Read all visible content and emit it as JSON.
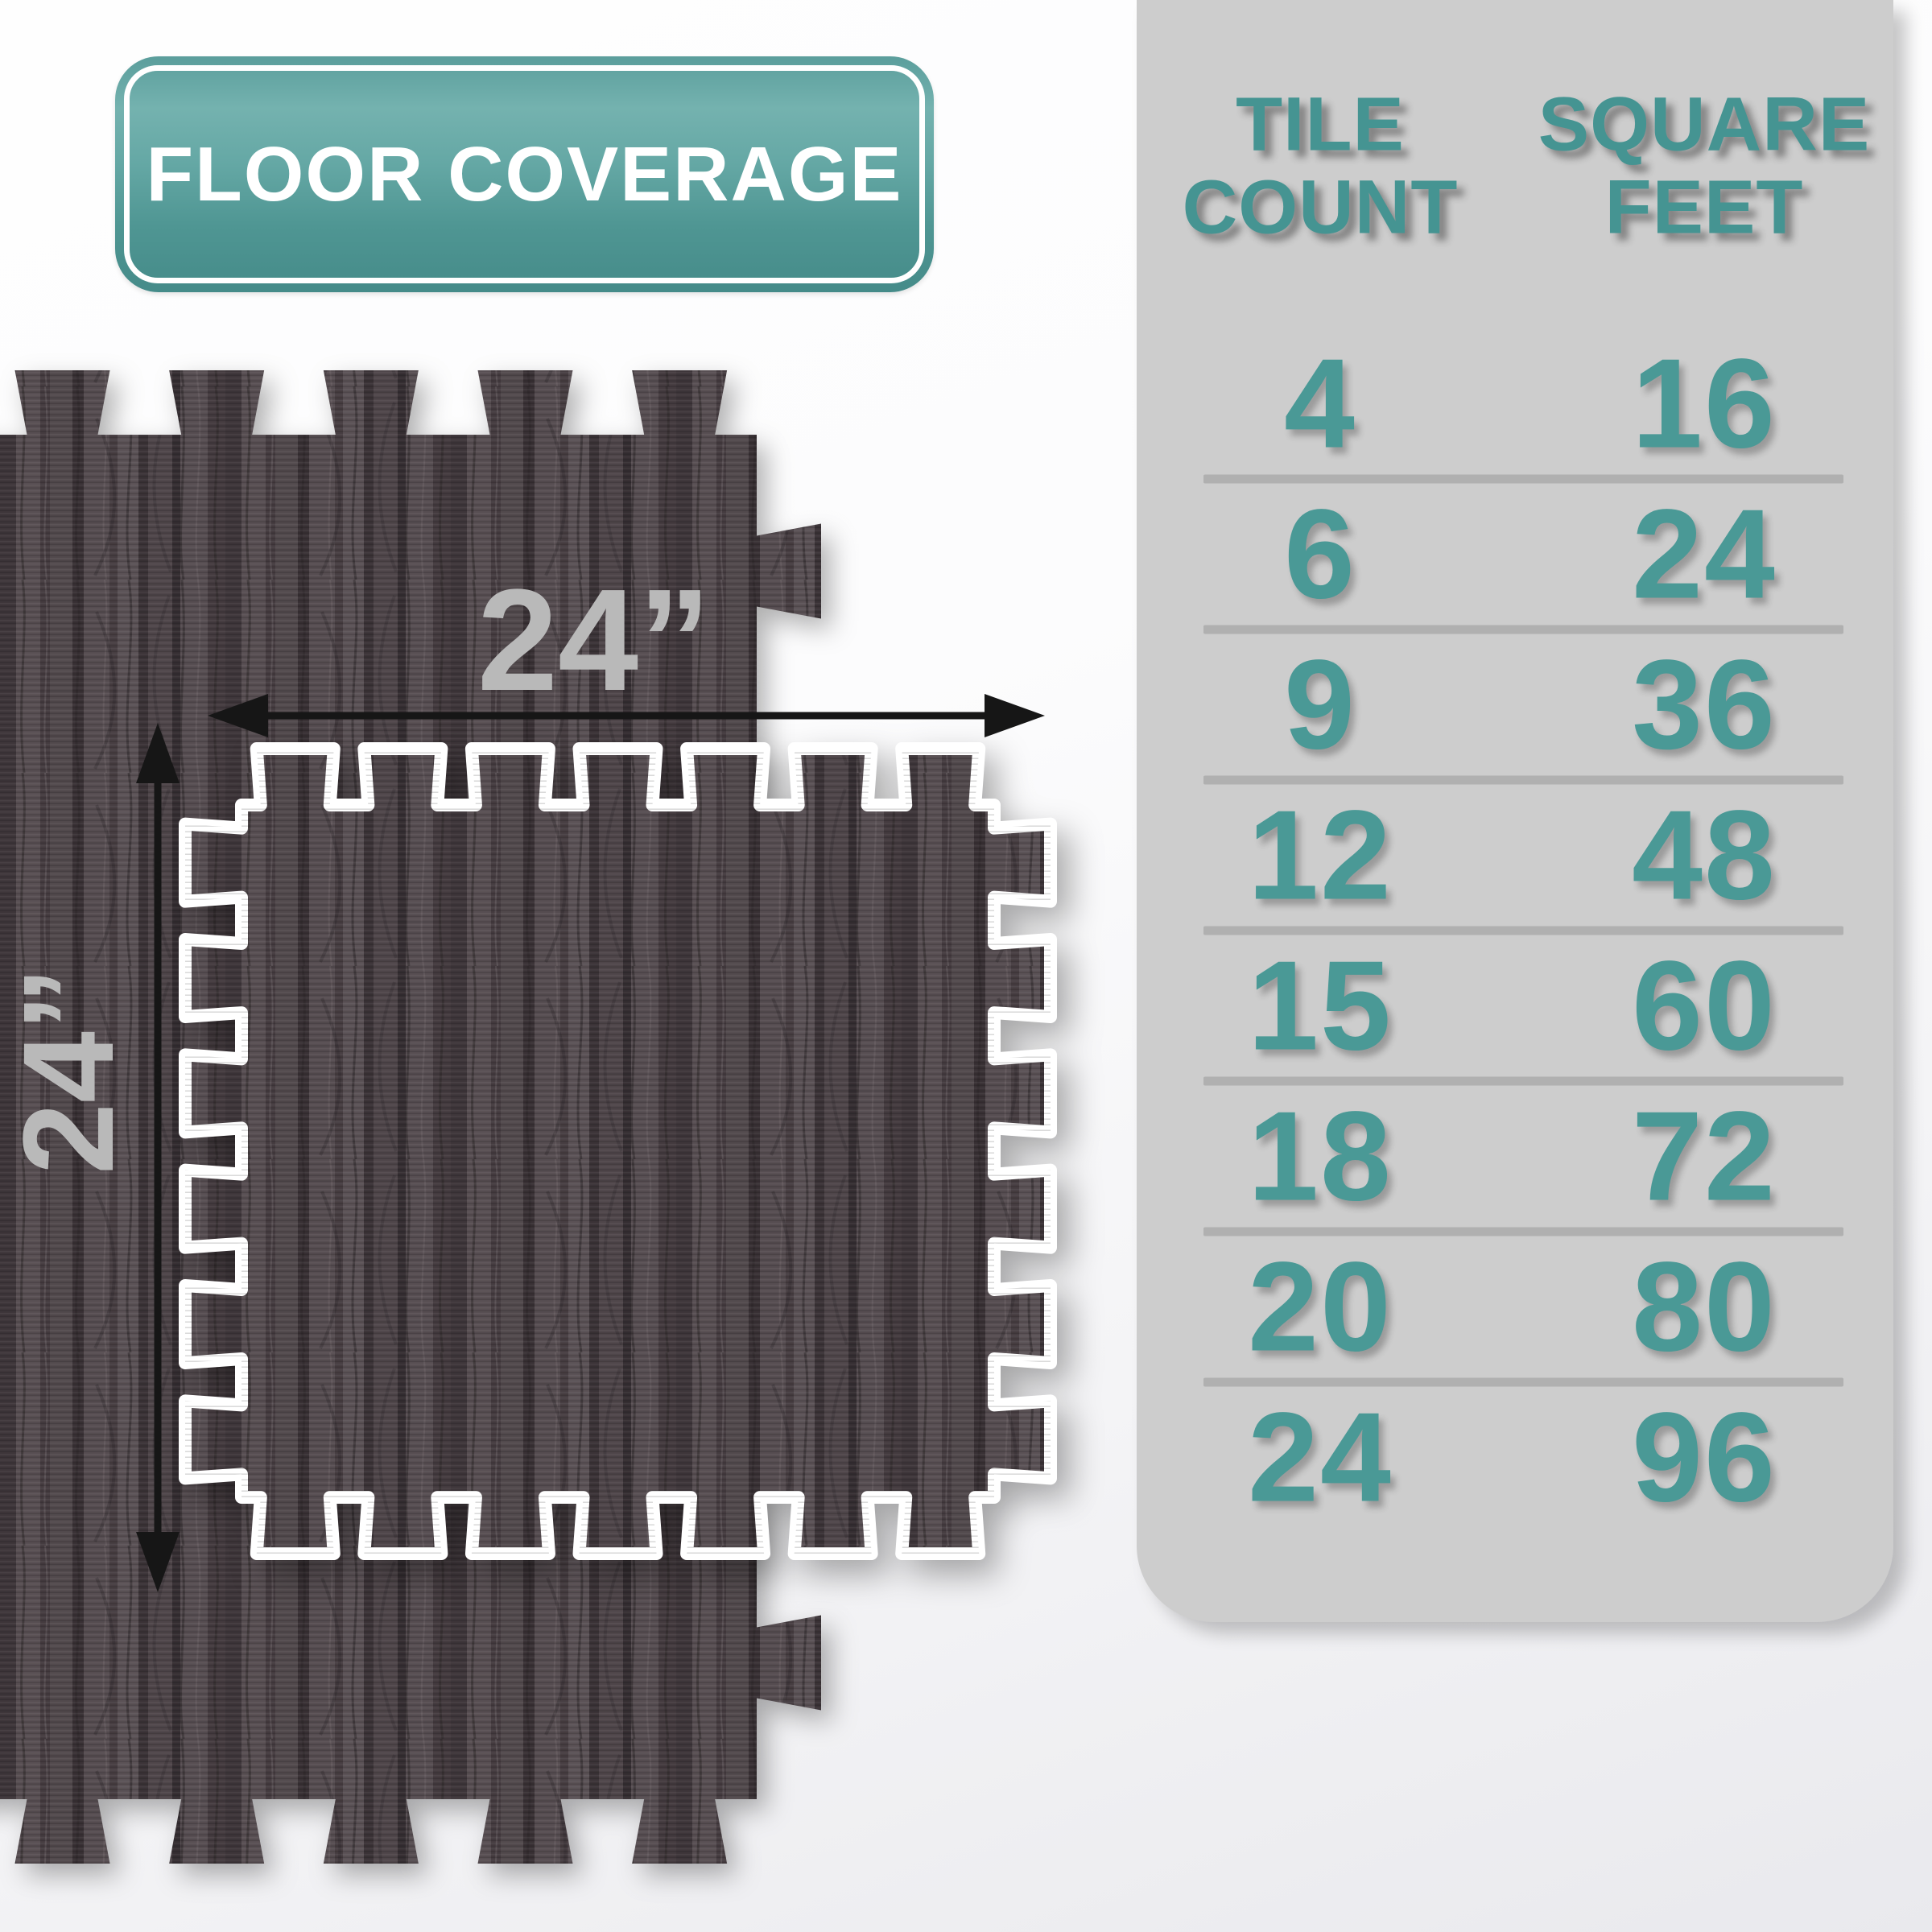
{
  "badge": {
    "label": "FLOOR COVERAGE"
  },
  "diagram": {
    "width_label": "24”",
    "height_label": "24”"
  },
  "coverage_table": {
    "columns": [
      {
        "line1": "TILE",
        "line2": "COUNT"
      },
      {
        "line1": "SQUARE",
        "line2": "FEET"
      }
    ],
    "rows": [
      {
        "tile_count": "4",
        "square_feet": "16"
      },
      {
        "tile_count": "6",
        "square_feet": "24"
      },
      {
        "tile_count": "9",
        "square_feet": "36"
      },
      {
        "tile_count": "12",
        "square_feet": "48"
      },
      {
        "tile_count": "15",
        "square_feet": "60"
      },
      {
        "tile_count": "18",
        "square_feet": "72"
      },
      {
        "tile_count": "20",
        "square_feet": "80"
      },
      {
        "tile_count": "24",
        "square_feet": "96"
      }
    ]
  },
  "colors": {
    "accent_teal": "#4a9996",
    "badge_teal": "#5b9e9c",
    "panel_gray": "#cdcdcd",
    "dimension_gray": "#b9b9b9",
    "wood_dark": "#4e4548",
    "tile_outline": "#ffffff",
    "arrow_black": "#161616"
  }
}
